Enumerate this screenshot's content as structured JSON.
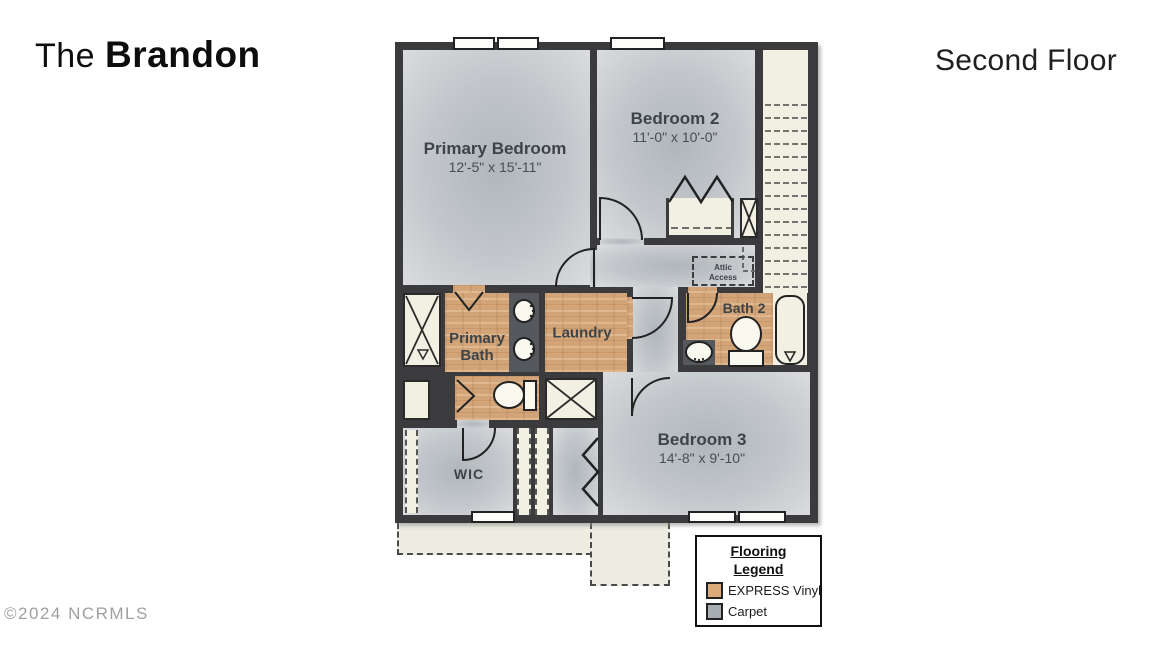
{
  "header": {
    "title_prefix": "The ",
    "title_name": "Brandon",
    "floor": "Second Floor"
  },
  "footer": {
    "copyright": "©2024 NCRMLS"
  },
  "rooms": {
    "primary_bedroom": {
      "name": "Primary Bedroom",
      "dims": "12'-5\" x 15'-11\"",
      "flooring": "Carpet"
    },
    "bedroom2": {
      "name": "Bedroom 2",
      "dims": "11'-0\" x 10'-0\"",
      "flooring": "Carpet"
    },
    "bedroom3": {
      "name": "Bedroom 3",
      "dims": "14'-8\" x 9'-10\"",
      "flooring": "Carpet"
    },
    "primary_bath": {
      "name_line1": "Primary",
      "name_line2": "Bath",
      "flooring": "EXPRESS Vinyl"
    },
    "laundry": {
      "name": "Laundry",
      "flooring": "EXPRESS Vinyl"
    },
    "bath2": {
      "name": "Bath 2",
      "flooring": "EXPRESS Vinyl"
    },
    "wic": {
      "name": "WIC",
      "flooring": "Carpet"
    },
    "attic": {
      "line1": "Attic",
      "line2": "Access"
    }
  },
  "legend": {
    "title_line1": "Flooring",
    "title_line2": "Legend",
    "items": [
      {
        "label": "EXPRESS Vinyl",
        "swatch": "#dcab7a"
      },
      {
        "label": "Carpet",
        "swatch": "#a7adb3"
      }
    ]
  },
  "colors": {
    "wall": "#3b3b3d",
    "carpet_center": "#b0b6bc",
    "carpet_edge": "#dadcde",
    "vinyl": "#d2a478",
    "fixture_cream": "#f1f0e3",
    "vanity": "#55595d"
  }
}
